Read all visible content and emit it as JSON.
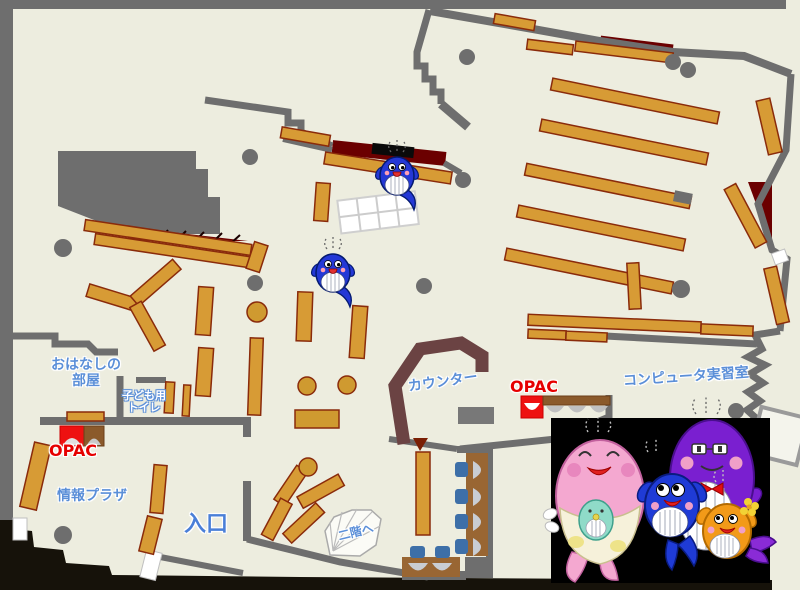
{
  "page_title": "Library floor map (1F)",
  "labels": {
    "storytelling_room_1": "おはなしの",
    "storytelling_room_2": "部屋",
    "kids_toilet_1": "子ども用",
    "kids_toilet_2": "トイレ",
    "opac_left": "OPAC",
    "info_plaza": "情報プラザ",
    "entrance": "入口",
    "counter": "カウンター",
    "opac_right": "OPAC",
    "computer_room": "コンピュータ実習室",
    "to_second_floor": "二階へ"
  },
  "icons": {
    "whale_mascot": "blue whale library mascot (2 on map)",
    "mascot_family_photo": "photo of whale mascot family: pink mother with baby, blue child, purple father with glasses and bow tie, orange child with flower",
    "opac_terminal": "red terminal with arch screen",
    "stairs": "white fan-shaped staircase to 2nd floor"
  },
  "colors": {
    "floor": "#EDEDDF",
    "walls": "#6E6E6E",
    "bookshelf": "#D79B35",
    "bookshelf_border": "#8A2B0B",
    "stack_dark_red": "#6B0000",
    "counter_brown": "#6B4343",
    "label_blue": "#5B8FD8",
    "opac_red": "#E60000",
    "chair_blue": "#3D6FA8",
    "desk_brown": "#996633",
    "outside_dark": "#16120A",
    "photo_background": "#000000"
  }
}
